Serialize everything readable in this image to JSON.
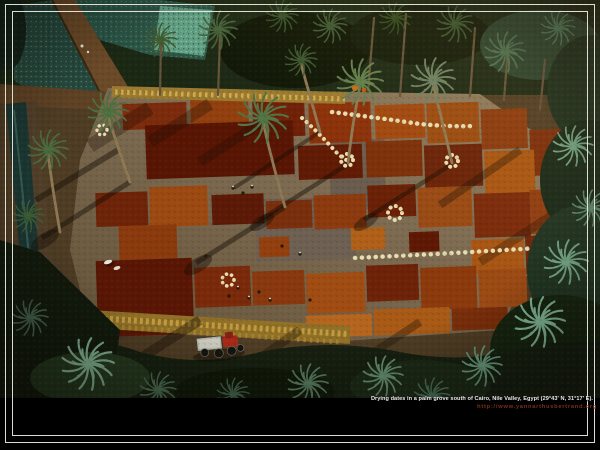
{
  "window": {
    "width": 600,
    "height": 450
  },
  "caption": {
    "title": "Drying dates in a palm grove south of  Cairo, Nile Valley, Egypt (29°43' N, 31°17' E).",
    "credit_url": "http://www.yannarthusbertrand.org"
  },
  "colors": {
    "background": "#000000",
    "frame_keyline": "#e8e8e2",
    "caption_text": "#ececec",
    "credit_text": "#7a3018",
    "field_teal": "#2b5547",
    "field_teal_bright": "#5f9f85",
    "canal_water": "#1c3733",
    "clearing_ground": "#7b6950",
    "date_dark_red": "#591503",
    "date_brick_red": "#8a3009",
    "date_rust": "#a85512",
    "date_orange": "#b5651d",
    "straw_gold": "#c9a144",
    "sack_cream": "#e8dcb2",
    "palm_green": "#527446",
    "palm_teal": "#7fb494",
    "canopy_dark": "#15220f",
    "trunk_brown": "#8d7854",
    "tractor_red": "#a62818",
    "trailer_gray": "#b6b6aa"
  }
}
